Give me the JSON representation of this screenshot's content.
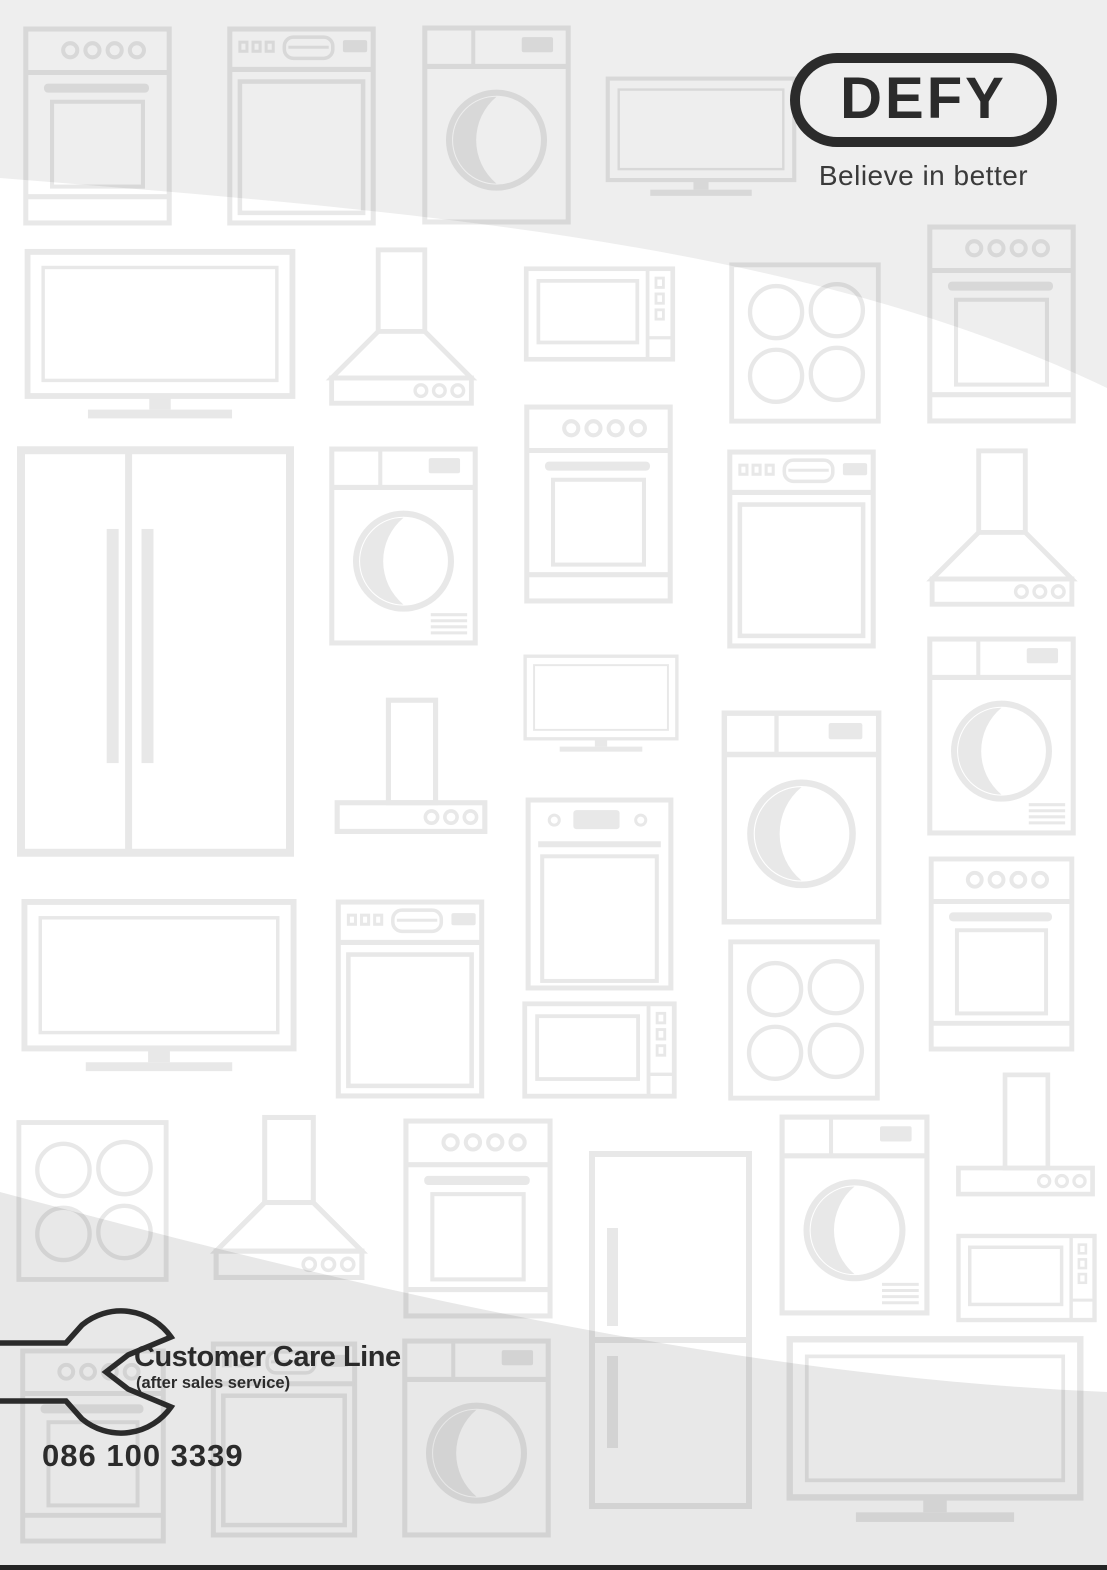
{
  "colors": {
    "page_bg": "#ffffff",
    "ink": "#2b2b2b",
    "tagline_ink": "#3a3a3a",
    "pattern_line": "#e8e8e8",
    "band_top": "rgba(40,40,40,0.078)",
    "band_bottom": "rgba(40,40,40,0.105)",
    "footer_bar": "#242424"
  },
  "logo": {
    "wordmark": "DEFY",
    "tagline": "Believe in better"
  },
  "customer_care": {
    "title": "Customer Care Line",
    "subtitle": "(after sales service)",
    "phone": "086 100 3339"
  },
  "background_pattern": {
    "description": "faint line-art outlines of home appliances",
    "icons": [
      {
        "type": "stove",
        "x": 15,
        "y": 25,
        "w": 165,
        "h": 202
      },
      {
        "type": "dishwasher",
        "x": 225,
        "y": 25,
        "w": 153,
        "h": 202
      },
      {
        "type": "washer",
        "x": 416,
        "y": 24,
        "w": 161,
        "h": 202
      },
      {
        "type": "tv",
        "x": 605,
        "y": 55,
        "w": 192,
        "h": 172
      },
      {
        "type": "stove",
        "x": 920,
        "y": 223,
        "w": 163,
        "h": 202
      },
      {
        "type": "tv",
        "x": 15,
        "y": 248,
        "w": 290,
        "h": 185
      },
      {
        "type": "hood",
        "x": 320,
        "y": 246,
        "w": 163,
        "h": 165
      },
      {
        "type": "micro",
        "x": 518,
        "y": 265,
        "w": 163,
        "h": 98
      },
      {
        "type": "hob",
        "x": 725,
        "y": 261,
        "w": 160,
        "h": 164
      },
      {
        "type": "fridgesbs",
        "x": 16,
        "y": 445,
        "w": 279,
        "h": 413
      },
      {
        "type": "dryer",
        "x": 322,
        "y": 445,
        "w": 163,
        "h": 202
      },
      {
        "type": "stove",
        "x": 515,
        "y": 403,
        "w": 167,
        "h": 202
      },
      {
        "type": "dishwasher",
        "x": 720,
        "y": 448,
        "w": 163,
        "h": 202
      },
      {
        "type": "hood",
        "x": 921,
        "y": 447,
        "w": 162,
        "h": 165
      },
      {
        "type": "hoodwall",
        "x": 329,
        "y": 690,
        "w": 164,
        "h": 166
      },
      {
        "type": "tv",
        "x": 519,
        "y": 654,
        "w": 164,
        "h": 106
      },
      {
        "type": "washer",
        "x": 720,
        "y": 700,
        "w": 163,
        "h": 235
      },
      {
        "type": "dryer",
        "x": 920,
        "y": 635,
        "w": 163,
        "h": 202
      },
      {
        "type": "tv",
        "x": 14,
        "y": 898,
        "w": 290,
        "h": 188
      },
      {
        "type": "dishwasher",
        "x": 330,
        "y": 898,
        "w": 160,
        "h": 202
      },
      {
        "type": "ovenwall",
        "x": 517,
        "y": 796,
        "w": 165,
        "h": 196
      },
      {
        "type": "micro",
        "x": 517,
        "y": 1000,
        "w": 165,
        "h": 100
      },
      {
        "type": "hob",
        "x": 725,
        "y": 938,
        "w": 158,
        "h": 164
      },
      {
        "type": "stove",
        "x": 920,
        "y": 855,
        "w": 163,
        "h": 198
      },
      {
        "type": "hob",
        "x": 15,
        "y": 1115,
        "w": 155,
        "h": 172
      },
      {
        "type": "hood",
        "x": 208,
        "y": 1112,
        "w": 162,
        "h": 175
      },
      {
        "type": "stove",
        "x": 398,
        "y": 1117,
        "w": 160,
        "h": 203
      },
      {
        "type": "fridgetb",
        "x": 588,
        "y": 1123,
        "w": 165,
        "h": 414
      },
      {
        "type": "dryer",
        "x": 773,
        "y": 1113,
        "w": 163,
        "h": 204
      },
      {
        "type": "hoodwall",
        "x": 951,
        "y": 1066,
        "w": 149,
        "h": 150
      },
      {
        "type": "micro",
        "x": 955,
        "y": 1230,
        "w": 143,
        "h": 96
      },
      {
        "type": "stove",
        "x": 13,
        "y": 1347,
        "w": 160,
        "h": 198
      },
      {
        "type": "dishwasher",
        "x": 203,
        "y": 1340,
        "w": 162,
        "h": 199
      },
      {
        "type": "washer",
        "x": 395,
        "y": 1337,
        "w": 163,
        "h": 202
      },
      {
        "type": "tv",
        "x": 777,
        "y": 1335,
        "w": 316,
        "h": 203
      }
    ]
  }
}
